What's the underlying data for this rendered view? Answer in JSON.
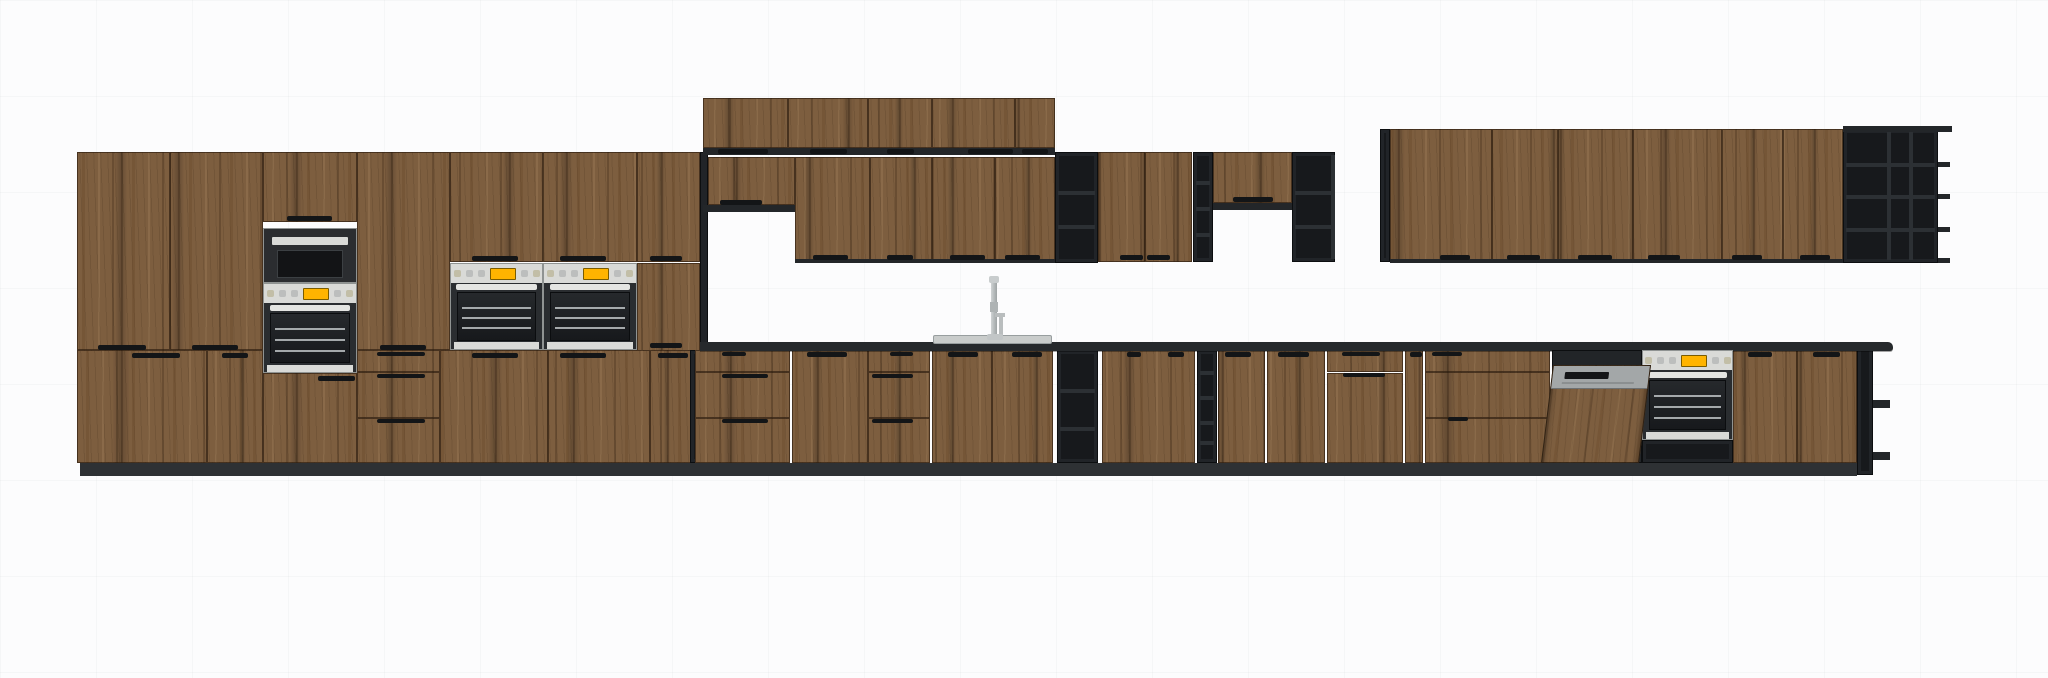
{
  "meta": {
    "scene_title": "kitchen-elevation-render",
    "canvas": {
      "w": 2048,
      "h": 678
    }
  },
  "colors": {
    "wood": "#7d5e3f",
    "dark": "#17191c",
    "counter": "#26292c",
    "steel": "#d9dad7",
    "amber": "#ffb400",
    "sink": "#c9cccb"
  },
  "scene": {
    "tall": [
      {
        "n": "tall-upper-door-1",
        "k": "door",
        "x": 77,
        "y": 152,
        "w": 93,
        "h": 198
      },
      {
        "n": "tall-upper-door-2",
        "k": "door",
        "x": 170,
        "y": 152,
        "w": 93,
        "h": 198
      },
      {
        "n": "oven-tower-top-door",
        "k": "door",
        "x": 263,
        "y": 152,
        "w": 94,
        "h": 70
      },
      {
        "n": "tall-upper-door-3",
        "k": "door",
        "x": 357,
        "y": 152,
        "w": 93,
        "h": 198
      },
      {
        "n": "above-oven-door-1",
        "k": "door",
        "x": 450,
        "y": 152,
        "w": 93,
        "h": 110
      },
      {
        "n": "above-oven-door-2",
        "k": "door",
        "x": 543,
        "y": 152,
        "w": 94,
        "h": 110
      },
      {
        "n": "above-oven-door-3",
        "k": "door",
        "x": 637,
        "y": 152,
        "w": 63,
        "h": 110
      },
      {
        "n": "beside-oven-door",
        "k": "door",
        "x": 637,
        "y": 263,
        "w": 63,
        "h": 88
      },
      {
        "n": "tall-lower-door-1",
        "k": "door",
        "x": 77,
        "y": 350,
        "w": 130,
        "h": 113
      },
      {
        "n": "tall-lower-door-2",
        "k": "door",
        "x": 207,
        "y": 350,
        "w": 56,
        "h": 113
      },
      {
        "n": "oven-tower-bottom-door",
        "k": "door",
        "x": 263,
        "y": 373,
        "w": 94,
        "h": 90
      },
      {
        "n": "tall-drawer-1",
        "k": "drawer",
        "x": 357,
        "y": 350,
        "w": 83,
        "h": 22
      },
      {
        "n": "tall-drawer-2",
        "k": "drawer",
        "x": 357,
        "y": 372,
        "w": 83,
        "h": 46
      },
      {
        "n": "tall-drawer-3",
        "k": "drawer",
        "x": 357,
        "y": 418,
        "w": 83,
        "h": 45
      },
      {
        "n": "tall-lower-door-3",
        "k": "door",
        "x": 440,
        "y": 350,
        "w": 108,
        "h": 113
      },
      {
        "n": "tall-lower-door-4",
        "k": "door",
        "x": 548,
        "y": 350,
        "w": 102,
        "h": 113
      },
      {
        "n": "tall-lower-door-5",
        "k": "door",
        "x": 650,
        "y": 350,
        "w": 50,
        "h": 113
      },
      {
        "n": "tall-run-side-panel",
        "k": "dark",
        "i": 0,
        "x": 700,
        "y": 152,
        "w": 8,
        "h": 198
      }
    ],
    "upper": [
      {
        "n": "wall-top-door-1",
        "k": "door",
        "x": 703,
        "y": 98,
        "w": 85,
        "h": 50
      },
      {
        "n": "wall-top-door-2",
        "k": "door",
        "x": 788,
        "y": 98,
        "w": 80,
        "h": 50
      },
      {
        "n": "wall-top-door-3",
        "k": "door",
        "x": 868,
        "y": 98,
        "w": 64,
        "h": 50
      },
      {
        "n": "wall-top-door-4",
        "k": "door",
        "x": 932,
        "y": 98,
        "w": 83,
        "h": 50
      },
      {
        "n": "wall-top-door-5",
        "k": "door",
        "x": 1015,
        "y": 98,
        "w": 40,
        "h": 50
      },
      {
        "n": "wall-top-underside",
        "k": "strip",
        "x": 703,
        "y": 148,
        "w": 352,
        "h": 7
      },
      {
        "n": "wall-mid-left-door",
        "k": "door",
        "x": 708,
        "y": 157,
        "w": 87,
        "h": 48
      },
      {
        "n": "wall-mid-left-underside",
        "k": "strip",
        "x": 703,
        "y": 205,
        "w": 92,
        "h": 7
      },
      {
        "n": "wall-mid-door-1",
        "k": "door",
        "x": 795,
        "y": 157,
        "w": 75,
        "h": 106
      },
      {
        "n": "wall-mid-door-2",
        "k": "door",
        "x": 870,
        "y": 157,
        "w": 62,
        "h": 106
      },
      {
        "n": "wall-mid-door-3",
        "k": "door",
        "x": 932,
        "y": 157,
        "w": 63,
        "h": 106
      },
      {
        "n": "wall-mid-door-4",
        "k": "door",
        "x": 995,
        "y": 157,
        "w": 60,
        "h": 106
      },
      {
        "n": "wall-mid-underside",
        "k": "strip",
        "x": 795,
        "y": 259,
        "w": 260,
        "h": 4
      },
      {
        "n": "open-shelf-unit-a",
        "k": "dark",
        "x": 1055,
        "y": 152,
        "w": 43,
        "h": 111,
        "sh": [
          190,
          224
        ]
      },
      {
        "n": "wall-door-pair-1",
        "k": "door",
        "x": 1098,
        "y": 152,
        "w": 47,
        "h": 110
      },
      {
        "n": "wall-door-pair-2",
        "k": "door",
        "x": 1145,
        "y": 152,
        "w": 47,
        "h": 110
      },
      {
        "n": "open-shelf-unit-b-narrow",
        "k": "dark",
        "x": 1193,
        "y": 152,
        "w": 20,
        "h": 110,
        "sh": [
          180,
          206,
          232
        ]
      },
      {
        "n": "wall-half-height-door",
        "k": "door",
        "x": 1213,
        "y": 152,
        "w": 79,
        "h": 51
      },
      {
        "n": "wall-half-height-underside",
        "k": "strip",
        "x": 1213,
        "y": 203,
        "w": 79,
        "h": 7
      },
      {
        "n": "open-shelf-unit-c",
        "k": "dark",
        "x": 1292,
        "y": 152,
        "w": 43,
        "h": 110,
        "sh": [
          190,
          224
        ],
        "dv": [
          1330
        ]
      },
      {
        "n": "right-run-side-panel",
        "k": "dark",
        "i": 0,
        "x": 1380,
        "y": 129,
        "w": 10,
        "h": 133
      },
      {
        "n": "right-wall-door-1",
        "k": "door",
        "x": 1390,
        "y": 129,
        "w": 102,
        "h": 133
      },
      {
        "n": "right-wall-door-2",
        "k": "door",
        "x": 1492,
        "y": 129,
        "w": 66,
        "h": 133
      },
      {
        "n": "right-wall-door-3",
        "k": "door",
        "x": 1558,
        "y": 129,
        "w": 75,
        "h": 133
      },
      {
        "n": "right-wall-door-4",
        "k": "door",
        "x": 1633,
        "y": 129,
        "w": 89,
        "h": 133
      },
      {
        "n": "right-wall-door-5",
        "k": "door",
        "x": 1722,
        "y": 129,
        "w": 61,
        "h": 133
      },
      {
        "n": "right-wall-door-6",
        "k": "door",
        "x": 1783,
        "y": 129,
        "w": 60,
        "h": 133
      },
      {
        "n": "right-wall-underside",
        "k": "strip",
        "x": 1390,
        "y": 259,
        "w": 453,
        "h": 4
      },
      {
        "n": "end-open-shelf-unit",
        "k": "dark",
        "x": 1843,
        "y": 129,
        "w": 95,
        "h": 134,
        "sh": [
          162,
          194,
          227
        ],
        "dv": [
          1886,
          1908
        ]
      },
      {
        "n": "end-shelf-top-lip",
        "k": "strip",
        "x": 1843,
        "y": 126,
        "w": 109,
        "h": 6
      },
      {
        "n": "end-shelf-lip-1",
        "k": "strip",
        "x": 1938,
        "y": 162,
        "w": 12,
        "h": 5
      },
      {
        "n": "end-shelf-lip-2",
        "k": "strip",
        "x": 1938,
        "y": 194,
        "w": 12,
        "h": 5
      },
      {
        "n": "end-shelf-lip-3",
        "k": "strip",
        "x": 1938,
        "y": 227,
        "w": 12,
        "h": 5
      },
      {
        "n": "end-shelf-lip-4",
        "k": "strip",
        "x": 1938,
        "y": 258,
        "w": 12,
        "h": 5
      }
    ],
    "base": [
      {
        "n": "base-side-filler",
        "k": "dark",
        "i": 0,
        "x": 690,
        "y": 350,
        "w": 12,
        "h": 113
      },
      {
        "n": "base-drawer-a1",
        "k": "drawer",
        "x": 695,
        "y": 350,
        "w": 95,
        "h": 22
      },
      {
        "n": "base-drawer-a2",
        "k": "drawer",
        "x": 695,
        "y": 372,
        "w": 95,
        "h": 46
      },
      {
        "n": "base-drawer-a3",
        "k": "drawer",
        "x": 695,
        "y": 418,
        "w": 95,
        "h": 45
      },
      {
        "n": "base-door-1",
        "k": "door",
        "x": 792,
        "y": 350,
        "w": 76,
        "h": 113
      },
      {
        "n": "base-drawer-b1",
        "k": "drawer",
        "x": 868,
        "y": 350,
        "w": 62,
        "h": 22
      },
      {
        "n": "base-drawer-b2",
        "k": "drawer",
        "x": 868,
        "y": 372,
        "w": 62,
        "h": 46
      },
      {
        "n": "base-drawer-b3",
        "k": "drawer",
        "x": 868,
        "y": 418,
        "w": 62,
        "h": 45
      },
      {
        "n": "sink-base-door-1",
        "k": "door",
        "x": 932,
        "y": 350,
        "w": 60,
        "h": 113
      },
      {
        "n": "sink-base-door-2",
        "k": "door",
        "x": 992,
        "y": 350,
        "w": 61,
        "h": 113
      },
      {
        "n": "base-open-shelf-a",
        "k": "dark",
        "x": 1057,
        "y": 350,
        "w": 41,
        "h": 113,
        "sh": [
          388,
          426
        ]
      },
      {
        "n": "base-door-2",
        "k": "door",
        "x": 1102,
        "y": 350,
        "w": 93,
        "h": 113
      },
      {
        "n": "base-open-shelf-b-narrow",
        "k": "dark",
        "x": 1197,
        "y": 350,
        "w": 20,
        "h": 113,
        "sh": [
          370,
          395,
          420,
          440
        ]
      },
      {
        "n": "base-door-3",
        "k": "door",
        "x": 1218,
        "y": 350,
        "w": 47,
        "h": 113
      },
      {
        "n": "base-door-4",
        "k": "door",
        "x": 1267,
        "y": 350,
        "w": 58,
        "h": 113
      },
      {
        "n": "base-drawer-c1",
        "k": "drawer",
        "x": 1327,
        "y": 350,
        "w": 76,
        "h": 22
      },
      {
        "n": "base-door-5",
        "k": "door",
        "x": 1327,
        "y": 373,
        "w": 76,
        "h": 90
      },
      {
        "n": "base-door-6-narrow",
        "k": "door",
        "x": 1405,
        "y": 350,
        "w": 18,
        "h": 113
      },
      {
        "n": "base-drawer-d1",
        "k": "drawer",
        "x": 1425,
        "y": 350,
        "w": 125,
        "h": 22
      },
      {
        "n": "base-drawer-d2",
        "k": "drawer",
        "x": 1425,
        "y": 372,
        "w": 125,
        "h": 46
      },
      {
        "n": "base-drawer-d3",
        "k": "drawer",
        "x": 1425,
        "y": 418,
        "w": 125,
        "h": 45
      },
      {
        "n": "base-door-7",
        "k": "door",
        "x": 1733,
        "y": 350,
        "w": 64,
        "h": 113
      },
      {
        "n": "base-door-8",
        "k": "door",
        "x": 1797,
        "y": 350,
        "w": 60,
        "h": 113
      },
      {
        "n": "base-end-panel",
        "k": "dark",
        "i": 0,
        "x": 1857,
        "y": 343,
        "w": 16,
        "h": 132
      },
      {
        "n": "base-end-shelf-lip-1",
        "k": "strip",
        "x": 1873,
        "y": 400,
        "w": 17,
        "h": 8
      },
      {
        "n": "base-end-shelf-lip-2",
        "k": "strip",
        "x": 1873,
        "y": 452,
        "w": 17,
        "h": 8
      }
    ],
    "structure": [
      {
        "n": "countertop",
        "k": "counter",
        "i": 0,
        "x": 700,
        "y": 342,
        "w": 1193,
        "h": 9
      },
      {
        "n": "toe-kick",
        "k": "toekick",
        "i": 0,
        "x": 80,
        "y": 463,
        "w": 1777,
        "h": 13
      }
    ],
    "appliances": [
      {
        "n": "microwave",
        "k": "micro",
        "x": 263,
        "y": 228,
        "w": 94,
        "h": 55
      },
      {
        "n": "tower-oven",
        "k": "oven",
        "x": 263,
        "y": 283,
        "w": 94,
        "h": 90
      },
      {
        "n": "double-oven-left",
        "k": "oven",
        "x": 450,
        "y": 263,
        "w": 93,
        "h": 87
      },
      {
        "n": "double-oven-right",
        "k": "oven",
        "x": 543,
        "y": 263,
        "w": 94,
        "h": 87
      },
      {
        "n": "base-oven",
        "k": "oven",
        "x": 1642,
        "y": 350,
        "w": 91,
        "h": 90
      },
      {
        "n": "base-oven-plinth",
        "k": "dark",
        "i": 0,
        "x": 1642,
        "y": 440,
        "w": 91,
        "h": 23
      },
      {
        "n": "dishwasher-open",
        "k": "dw",
        "x": 1552,
        "y": 350,
        "w": 90,
        "h": 113
      },
      {
        "n": "sink",
        "k": "sink",
        "x": 933,
        "y": 335,
        "w": 119,
        "h": 9
      },
      {
        "n": "faucet",
        "k": "faucet",
        "x": 985,
        "y": 276,
        "w": 22,
        "h": 64
      }
    ],
    "handles": [
      [
        98,
        345,
        48,
        5
      ],
      [
        192,
        345,
        46,
        5
      ],
      [
        287,
        216,
        45,
        5
      ],
      [
        380,
        345,
        46,
        5
      ],
      [
        472,
        256,
        46,
        5
      ],
      [
        560,
        256,
        46,
        5
      ],
      [
        650,
        256,
        32,
        5
      ],
      [
        650,
        343,
        32,
        5
      ],
      [
        132,
        353,
        48,
        5
      ],
      [
        222,
        353,
        26,
        5
      ],
      [
        318,
        376,
        37,
        5
      ],
      [
        377,
        352,
        48,
        4
      ],
      [
        377,
        374,
        48,
        4
      ],
      [
        377,
        419,
        48,
        4
      ],
      [
        472,
        353,
        46,
        5
      ],
      [
        560,
        353,
        46,
        5
      ],
      [
        658,
        353,
        30,
        5
      ],
      [
        718,
        149,
        50,
        5
      ],
      [
        810,
        149,
        37,
        5
      ],
      [
        887,
        149,
        27,
        5
      ],
      [
        968,
        149,
        45,
        5
      ],
      [
        1022,
        149,
        26,
        5
      ],
      [
        720,
        200,
        42,
        5
      ],
      [
        813,
        255,
        35,
        5
      ],
      [
        887,
        255,
        26,
        5
      ],
      [
        950,
        255,
        35,
        5
      ],
      [
        1005,
        255,
        35,
        5
      ],
      [
        1120,
        255,
        23,
        5
      ],
      [
        1147,
        255,
        23,
        5
      ],
      [
        1233,
        197,
        40,
        5
      ],
      [
        1440,
        255,
        30,
        5
      ],
      [
        1507,
        255,
        33,
        5
      ],
      [
        1578,
        255,
        34,
        5
      ],
      [
        1648,
        255,
        32,
        5
      ],
      [
        1732,
        255,
        30,
        5
      ],
      [
        1800,
        255,
        30,
        5
      ],
      [
        722,
        352,
        24,
        4
      ],
      [
        722,
        374,
        46,
        4
      ],
      [
        722,
        419,
        46,
        4
      ],
      [
        807,
        352,
        40,
        5
      ],
      [
        890,
        352,
        23,
        4
      ],
      [
        872,
        374,
        41,
        4
      ],
      [
        872,
        419,
        41,
        4
      ],
      [
        948,
        352,
        30,
        5
      ],
      [
        1012,
        352,
        30,
        5
      ],
      [
        1127,
        352,
        14,
        5
      ],
      [
        1168,
        352,
        16,
        5
      ],
      [
        1225,
        352,
        26,
        5
      ],
      [
        1278,
        352,
        31,
        5
      ],
      [
        1342,
        352,
        38,
        4
      ],
      [
        1343,
        373,
        42,
        4
      ],
      [
        1410,
        352,
        12,
        5
      ],
      [
        1432,
        352,
        30,
        4
      ],
      [
        1448,
        417,
        20,
        4
      ],
      [
        1748,
        352,
        24,
        5
      ],
      [
        1813,
        352,
        27,
        5
      ]
    ]
  }
}
